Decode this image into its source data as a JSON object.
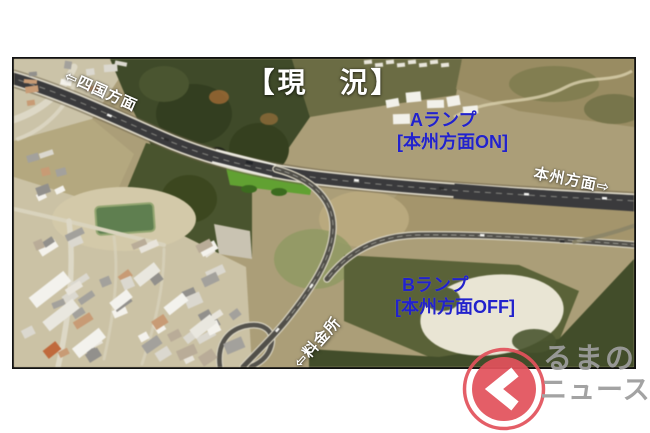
{
  "header": {
    "title": "【現　況】"
  },
  "annotations": {
    "shikoku_direction": "⇦四国方面",
    "ramp_a": {
      "line1": "Aランプ",
      "line2": "[本州方面ON]"
    },
    "honshu_direction": "本州方面⇨",
    "ramp_b": {
      "line1": "Bランプ",
      "line2": "[本州方面OFF]"
    },
    "tollgate": "⇦料金所"
  },
  "logo": {
    "line1": "るまの",
    "line2": "ニュース",
    "icon": "ku-chevron-icon"
  },
  "colors": {
    "annotation_blue": "#2222cc",
    "annotation_white": "#ffffff",
    "logo_red": "#e2525c",
    "logo_gray": "#9d9d9d"
  }
}
